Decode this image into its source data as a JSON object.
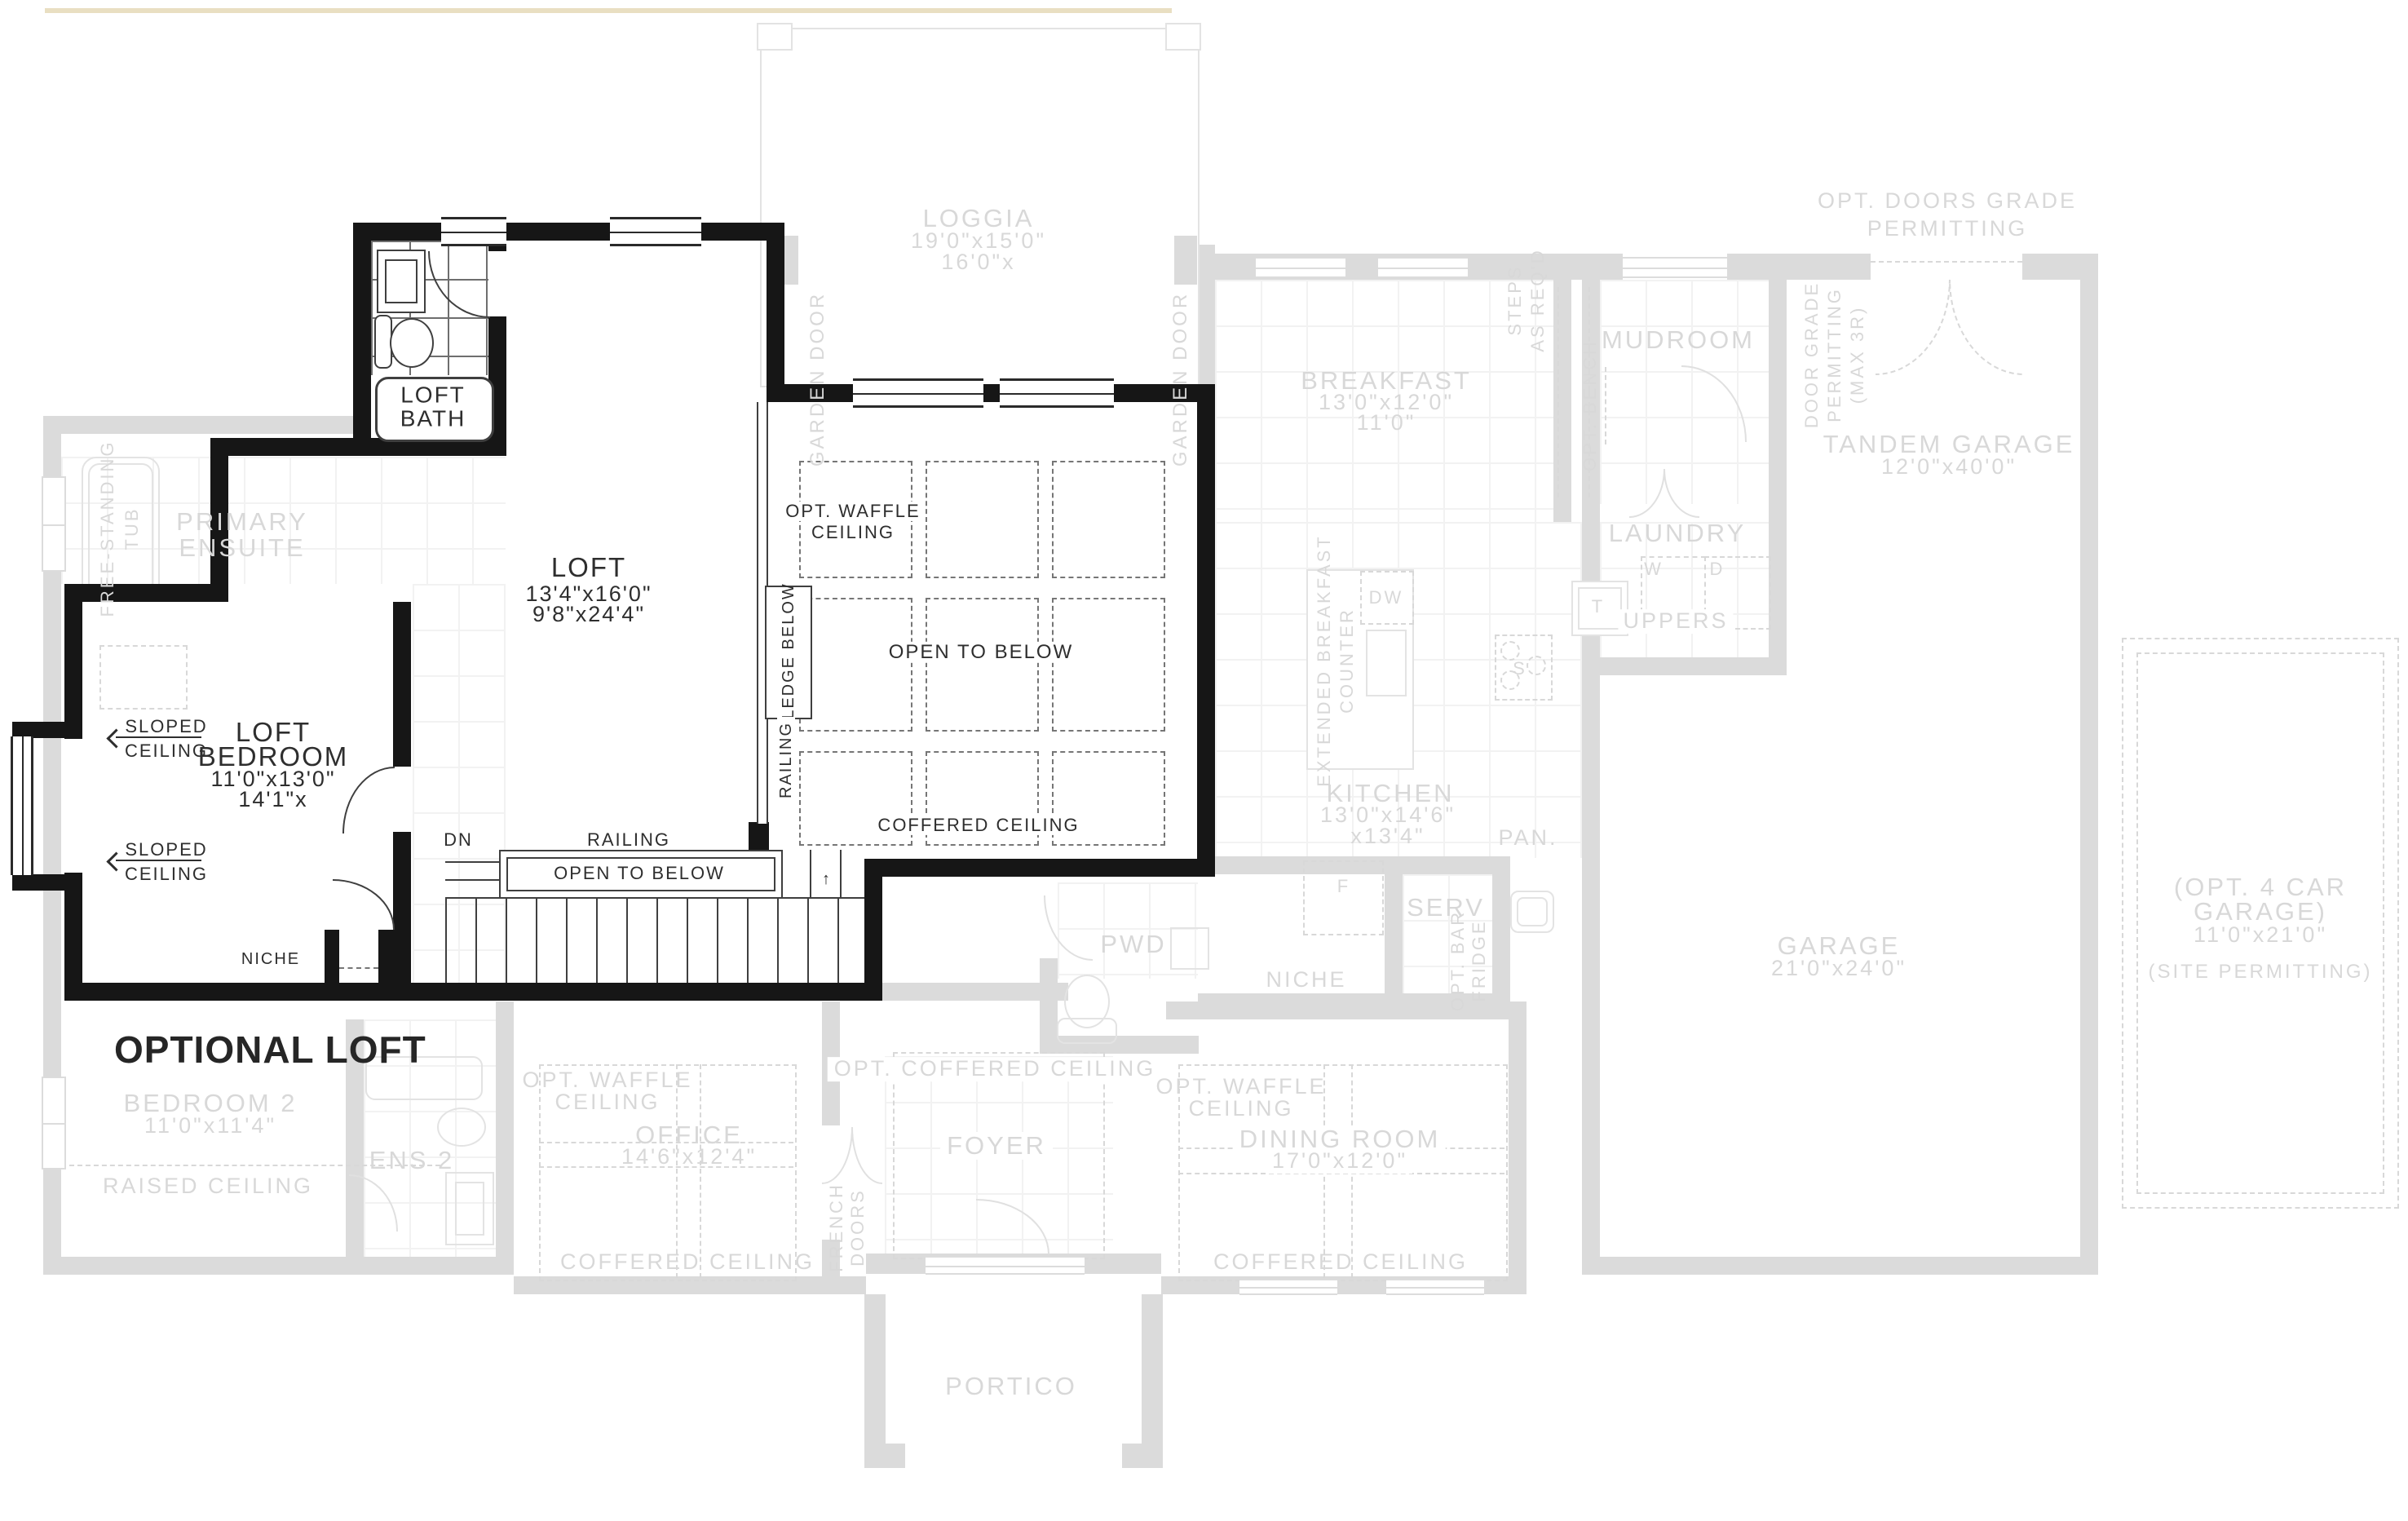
{
  "title": "OPTIONAL LOFT",
  "loft": {
    "bath1": "LOFT",
    "bath2": "BATH",
    "name": "LOFT",
    "dim1": "13'4\"x16'0\"",
    "dim2": "9'8\"x24'4\"",
    "bed1": "LOFT",
    "bed2": "BEDROOM",
    "bed_dim1": "11'0\"x13'0\"",
    "bed_dim2": "14'1\"x",
    "sloped": "SLOPED",
    "ceiling": "CEILING",
    "niche": "NICHE",
    "dn": "DN",
    "railing": "RAILING",
    "open_below": "OPEN TO BELOW",
    "waffle1": "OPT. WAFFLE",
    "waffle2": "CEILING",
    "coffered": "COFFERED CEILING",
    "ledge": "LEDGE BELOW",
    "railing_v": "RAILING"
  },
  "ghost": {
    "loggia": "LOGGIA",
    "loggia_d1": "19'0\"x15'0\"",
    "loggia_d2": "16'0\"x",
    "garden": "GARDEN DOOR",
    "primary1": "PRIMARY",
    "primary2": "ENSUITE",
    "tub1": "FREE-STANDING",
    "tub2": "TUB",
    "bed2": "BEDROOM 2",
    "bed2_d": "11'0\"x11'4\"",
    "raised": "RAISED CEILING",
    "ens2": "ENS 2",
    "office": "OFFICE",
    "office_d": "14'6\"x12'4\"",
    "waffle1": "OPT. WAFFLE",
    "waffle2": "CEILING",
    "coffered": "COFFERED CEILING",
    "french1": "FRENCH",
    "french2": "DOORS",
    "foyer": "FOYER",
    "opt_coffered": "OPT. COFFERED CEILING",
    "pwd": "PWD",
    "portico": "PORTICO",
    "dining": "DINING ROOM",
    "dining_d": "17'0\"x12'0\"",
    "breakfast": "BREAKFAST",
    "breakfast_d1": "13'0\"x12'0\"",
    "breakfast_d2": "11'0\"",
    "bench": "OPT. BENCH",
    "steps1": "STEPS",
    "steps2": "AS REQ'D",
    "mudroom": "MUDROOM",
    "grade1": "DOOR GRADE",
    "grade2": "PERMITTING",
    "grade3": "(MAX 3R)",
    "optdoors1": "OPT. DOORS GRADE",
    "optdoors2": "PERMITTING",
    "tandem": "TANDEM GARAGE",
    "tandem_d": "12'0\"x40'0\"",
    "laundry": "LAUNDRY",
    "uppers": "UPPERS",
    "w": "W",
    "d": "D",
    "t": "T",
    "f": "F",
    "s": "S",
    "dw": "DW",
    "kitchen": "KITCHEN",
    "kitchen_d1": "13'0\"x14'6\"",
    "kitchen_d2": "x13'4\"",
    "ext1": "EXTENDED BREAKFAST",
    "ext2": "COUNTER",
    "pan": "PAN.",
    "serv": "SERV",
    "niche": "NICHE",
    "bar1": "OPT. BAR",
    "bar2": "FRIDGE",
    "garage": "GARAGE",
    "garage_d": "21'0\"x24'0\"",
    "car41": "(OPT. 4 CAR",
    "car42": "GARAGE)",
    "car4_d": "11'0\"x21'0\"",
    "car4_n": "(SITE PERMITTING)"
  },
  "colors": {
    "wall": "#161616",
    "ghost": "#dbdbdb",
    "ghost_text": "#d8d8d8",
    "ink": "#2e2e2e",
    "tan": "#e9dfc2"
  }
}
